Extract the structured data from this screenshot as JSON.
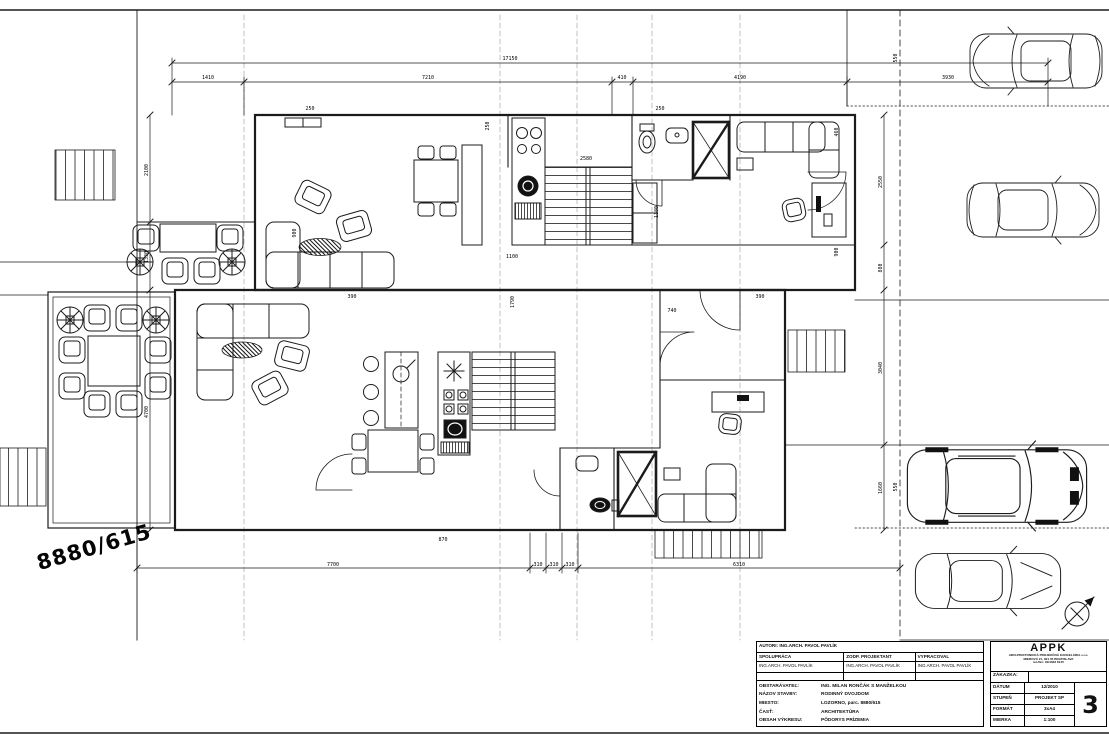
{
  "sheet": {
    "background": "#ffffff",
    "ink": "#1b1b1b"
  },
  "parcel_label": "8880/615",
  "icons": {
    "north_arrow": "compass-north-arrow-icon",
    "cars": [
      "car-top-view-1",
      "car-top-view-2",
      "car-top-view-suv",
      "car-top-view-4"
    ],
    "plants": "potted-plant-icon"
  },
  "title_block": {
    "authors_row": "AUTORI: ING.ARCH. PAVOL PAVLÍK",
    "cols": [
      {
        "header": "SPOLUPRÁCA",
        "name": "ING.ARCH. PAVOL PAVLÍK"
      },
      {
        "header": "ZODP. PROJEKTANT",
        "name": "ING.ARCH. PAVOL PAVLÍK"
      },
      {
        "header": "VYPRACOVAL",
        "name": "ING.ARCH. PAVOL PAVLÍK"
      }
    ],
    "rows": [
      {
        "label": "OBSTARÁVATEĽ:",
        "value": "ING. MILAN RONČÁK S MANŽELKOU"
      },
      {
        "label": "NÁZOV STAVBY:",
        "value": "RODINNÝ DVOJDOM"
      },
      {
        "label": "MIESTO:",
        "value": "LOZORNO, parc. 8880/615"
      },
      {
        "label": "ČASŤ:",
        "value": "ARCHITEKTÚRA"
      },
      {
        "label": "OBSAH VÝKRESU:",
        "value": "PÔDORYS PRÍZEMIA"
      }
    ],
    "company": {
      "name": "APPK",
      "lines": [
        "ARCHITEKTONICKÁ PROJEKČNÁ KANCELÁRIA s.r.o.",
        "MIEROVÁ 21, 821 05 BRATISLAVA",
        "tel./fax: 02/4363 8145"
      ]
    },
    "fields": [
      {
        "label": "ZÁKAZKA:",
        "value": ""
      },
      {
        "label": "DÁTUM",
        "value": "12/2010"
      },
      {
        "label": "STUPEŇ",
        "value": "PROJEKT SP"
      },
      {
        "label": "FORMÁT",
        "value": "3xA4"
      },
      {
        "label": "MIERKA",
        "value": "1:100"
      }
    ],
    "drawing_number": "3"
  },
  "dims": [
    {
      "x": 510,
      "y": 60,
      "t": "17150"
    },
    {
      "x": 208,
      "y": 79,
      "t": "1410"
    },
    {
      "x": 428,
      "y": 79,
      "t": "7210"
    },
    {
      "x": 622,
      "y": 79,
      "t": "410"
    },
    {
      "x": 740,
      "y": 79,
      "t": "4190"
    },
    {
      "x": 948,
      "y": 79,
      "t": "3930"
    },
    {
      "x": 333,
      "y": 566,
      "t": "7700"
    },
    {
      "x": 538,
      "y": 566,
      "t": "310"
    },
    {
      "x": 554,
      "y": 566,
      "t": "310"
    },
    {
      "x": 570,
      "y": 566,
      "t": "310"
    },
    {
      "x": 739,
      "y": 566,
      "t": "6310"
    },
    {
      "x": 148,
      "y": 170,
      "t": "2100",
      "r": -90
    },
    {
      "x": 148,
      "y": 257,
      "t": "1330",
      "r": -90
    },
    {
      "x": 148,
      "y": 412,
      "t": "4700",
      "r": -90
    },
    {
      "x": 882,
      "y": 182,
      "t": "2550",
      "r": -90
    },
    {
      "x": 882,
      "y": 268,
      "t": "880",
      "r": -90
    },
    {
      "x": 882,
      "y": 368,
      "t": "3040",
      "r": -90
    },
    {
      "x": 882,
      "y": 488,
      "t": "1660",
      "r": -90
    },
    {
      "x": 897,
      "y": 58,
      "t": "550",
      "r": -90
    },
    {
      "x": 897,
      "y": 487,
      "t": "550",
      "r": -90
    },
    {
      "x": 296,
      "y": 233,
      "t": "900",
      "r": -90
    },
    {
      "x": 489,
      "y": 126,
      "t": "250",
      "r": -90
    },
    {
      "x": 514,
      "y": 302,
      "t": "1790",
      "r": -90
    },
    {
      "x": 658,
      "y": 212,
      "t": "1180",
      "r": -90
    },
    {
      "x": 838,
      "y": 132,
      "t": "460",
      "r": -90
    },
    {
      "x": 838,
      "y": 252,
      "t": "900",
      "r": -90
    },
    {
      "x": 443,
      "y": 541,
      "t": "870"
    },
    {
      "x": 672,
      "y": 312,
      "t": "740"
    },
    {
      "x": 586,
      "y": 160,
      "t": "2580"
    },
    {
      "x": 512,
      "y": 258,
      "t": "1100"
    },
    {
      "x": 352,
      "y": 298,
      "t": "390"
    },
    {
      "x": 760,
      "y": 298,
      "t": "390"
    },
    {
      "x": 310,
      "y": 110,
      "t": "250"
    },
    {
      "x": 660,
      "y": 110,
      "t": "250"
    }
  ]
}
